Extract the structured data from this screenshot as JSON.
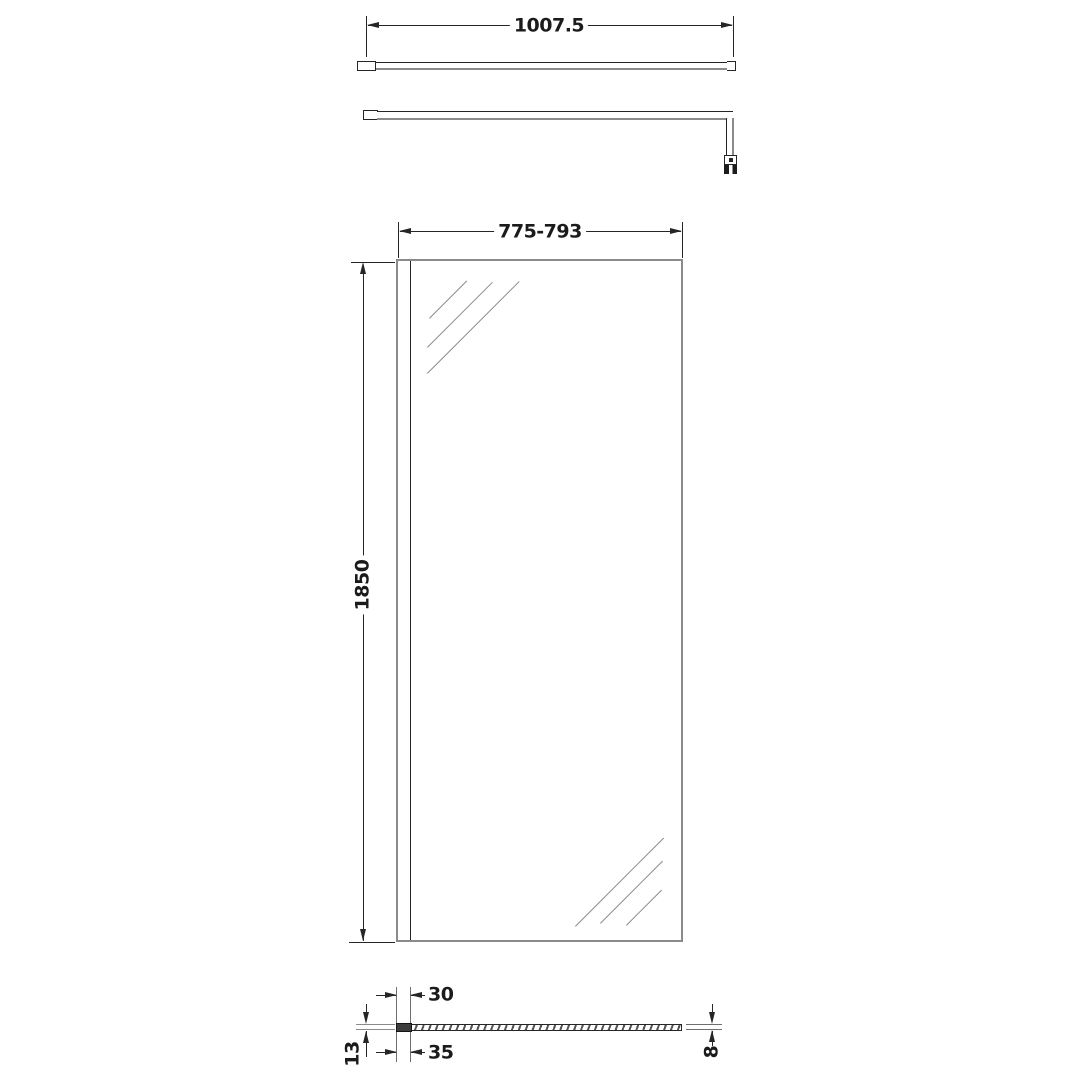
{
  "colors": {
    "background": "#ffffff",
    "line_dark": "#262626",
    "line_gray": "#8b8b8b",
    "text": "#1b1b1b"
  },
  "dimensions": {
    "support_bar_width": "1007.5",
    "panel_width_range": "775-793",
    "panel_height": "1850",
    "profile_glass_inset": "30",
    "profile_overall_width": "35",
    "profile_depth": "13",
    "glass_thickness": "8"
  }
}
